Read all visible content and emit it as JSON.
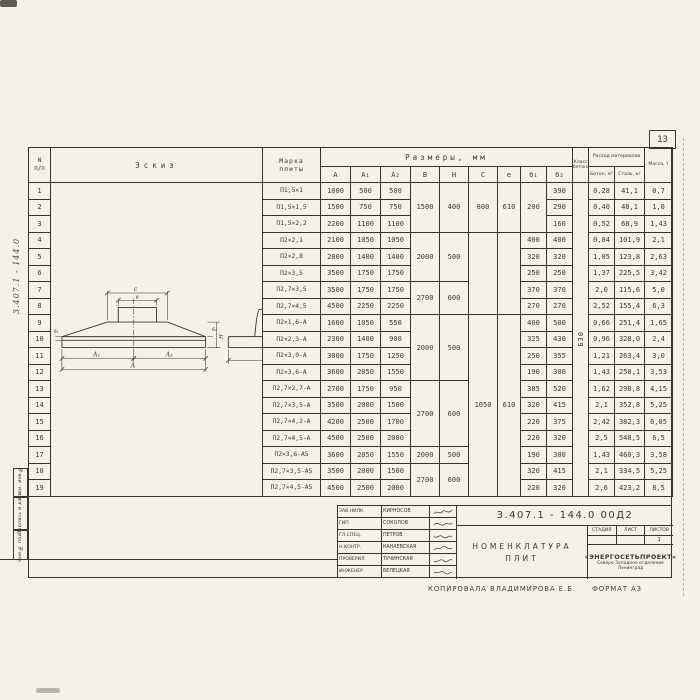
{
  "page": {
    "number": "13"
  },
  "margin": {
    "doc_number_vertical": "3.407.1 - 144.0",
    "stamps": [
      "Взам. инв.№",
      "Подпись и дата",
      "Инв.№ подл."
    ]
  },
  "footer": {
    "copied_by": "Копировала Владимирова Е.Б.",
    "format": "ФОРМАТ А3"
  },
  "sketch": {
    "labels": {
      "c": "с",
      "e": "е",
      "a1": "А₁",
      "a2": "А₂",
      "a": "А",
      "h": "Н",
      "b1": "б₁",
      "b2": "б₂",
      "b": "В",
      "n100": "100"
    }
  },
  "title_block": {
    "doc_number": "3.407.1 - 144.0  00Д2",
    "title_line1": "Номенклатура",
    "title_line2": "плит",
    "stage": "Стадия",
    "sheet": "Лист",
    "sheets": "Листов",
    "sheets_value": "1",
    "org_name": "«ЭНЕРГОСЕТЬПРОЕКТ»",
    "org_branch": "Северо-Западное отделение",
    "org_city": "Ленинград",
    "people": [
      {
        "role": "Зав.НИЛК",
        "name": "Кирносов"
      },
      {
        "role": "ГИП",
        "name": "Соколов"
      },
      {
        "role": "Гл.спец.",
        "name": "Петров"
      },
      {
        "role": "Н.контр.",
        "name": "Канаевская"
      },
      {
        "role": "Проверил",
        "name": "Тучинская"
      },
      {
        "role": "Инженер",
        "name": "Белецкая"
      }
    ]
  },
  "table": {
    "headers": {
      "num_top": "N",
      "num_bottom": "п/п",
      "sketch": "Эскиз",
      "mark_top": "Марка",
      "mark_bottom": "плиты",
      "dims": "Размеры, мм",
      "a": "А",
      "a1": "А₁",
      "a2": "А₂",
      "b": "В",
      "h": "Н",
      "c": "С",
      "e": "е",
      "b1": "б₁",
      "b2": "б₂",
      "class_label": "Класс бетона",
      "consumption": "Расход материалов",
      "concrete": "Бетон, м³",
      "steel": "Сталь, кг",
      "mass": "Масса, т"
    },
    "class_concrete": "Б30",
    "rows": [
      [
        "1",
        "П1,5×1",
        "1000",
        "500",
        "500",
        [
          "1500",
          3
        ],
        [
          "400",
          3
        ],
        [
          "800",
          3
        ],
        [
          "610",
          3
        ],
        [
          "200",
          3
        ],
        "390",
        [
          "Б30",
          19
        ],
        "0,28",
        "41,1",
        "0,7"
      ],
      [
        "2",
        "П1,5×1,5",
        "1500",
        "750",
        "750",
        null,
        null,
        null,
        null,
        null,
        "290",
        null,
        "0,40",
        "48,1",
        "1,0"
      ],
      [
        "3",
        "П1,5×2,2",
        "2200",
        "1100",
        "1100",
        null,
        null,
        null,
        null,
        null,
        "160",
        null,
        "0,52",
        "68,9",
        "1,43"
      ],
      [
        "4",
        "П2×2,1",
        "2100",
        "1050",
        "1050",
        [
          "2000",
          3
        ],
        [
          "500",
          3
        ],
        [
          "",
          5
        ],
        [
          "",
          5
        ],
        "400",
        "400",
        null,
        "0,84",
        "101,9",
        "2,1"
      ],
      [
        "5",
        "П2×2,8",
        "2800",
        "1400",
        "1400",
        null,
        null,
        null,
        null,
        "320",
        "320",
        null,
        "1,05",
        "123,8",
        "2,63"
      ],
      [
        "6",
        "П2×3,5",
        "3500",
        "1750",
        "1750",
        null,
        null,
        null,
        null,
        "250",
        "250",
        null,
        "1,37",
        "225,5",
        "3,42"
      ],
      [
        "7",
        "П2,7×3,5",
        "3500",
        "1750",
        "1750",
        [
          "2700",
          2
        ],
        [
          "600",
          2
        ],
        null,
        null,
        "370",
        "370",
        null,
        "2,0",
        "115,6",
        "5,0"
      ],
      [
        "8",
        "П2,7×4,5",
        "4500",
        "2250",
        "2250",
        null,
        null,
        null,
        null,
        "270",
        "270",
        null,
        "2,52",
        "155,4",
        "6,3"
      ],
      [
        "9",
        "П2×1,6-А",
        "1600",
        "1050",
        "550",
        [
          "2000",
          4
        ],
        [
          "500",
          4
        ],
        [
          "1050",
          11
        ],
        [
          "610",
          11
        ],
        "400",
        "500",
        null,
        "0,66",
        "251,4",
        "1,65"
      ],
      [
        "10",
        "П2×2,3-А",
        "2300",
        "1400",
        "900",
        null,
        null,
        null,
        null,
        "325",
        "430",
        null,
        "0,96",
        "328,0",
        "2,4"
      ],
      [
        "11",
        "П2×3,0-А",
        "3000",
        "1750",
        "1250",
        null,
        null,
        null,
        null,
        "250",
        "355",
        null,
        "1,21",
        "263,4",
        "3,0"
      ],
      [
        "12",
        "П2×3,6-А",
        "3600",
        "2050",
        "1550",
        null,
        null,
        null,
        null,
        "190",
        "300",
        null,
        "1,43",
        "250,1",
        "3,53"
      ],
      [
        "13",
        "П2,7×2,7-А",
        "2700",
        "1750",
        "950",
        [
          "2700",
          4
        ],
        [
          "600",
          4
        ],
        null,
        null,
        "385",
        "520",
        null,
        "1,62",
        "298,8",
        "4,15"
      ],
      [
        "14",
        "П2,7×3,5-А",
        "3500",
        "2000",
        "1500",
        null,
        null,
        null,
        null,
        "320",
        "415",
        null,
        "2,1",
        "352,8",
        "5,25"
      ],
      [
        "15",
        "П2,7×4,2-А",
        "4200",
        "2500",
        "1700",
        null,
        null,
        null,
        null,
        "220",
        "375",
        null,
        "2,42",
        "382,3",
        "6,05"
      ],
      [
        "16",
        "П2,7×4,5-А",
        "4500",
        "2500",
        "2000",
        null,
        null,
        null,
        null,
        "220",
        "320",
        null,
        "2,5",
        "548,5",
        "6,5"
      ],
      [
        "17",
        "П2×3,6-А5",
        "3600",
        "2050",
        "1550",
        [
          "2000",
          1
        ],
        [
          "500",
          1
        ],
        null,
        null,
        "190",
        "300",
        null,
        "1,43",
        "460,3",
        "3,58"
      ],
      [
        "18",
        "П2,7×3,5-А5",
        "3500",
        "2000",
        "1500",
        [
          "2700",
          2
        ],
        [
          "600",
          2
        ],
        null,
        null,
        "320",
        "415",
        null,
        "2,1",
        "334,5",
        "5,25"
      ],
      [
        "19",
        "П2,7×4,5-А5",
        "4500",
        "2500",
        "2000",
        null,
        null,
        null,
        null,
        "220",
        "320",
        null,
        "2,6",
        "423,2",
        "8,5"
      ]
    ]
  }
}
